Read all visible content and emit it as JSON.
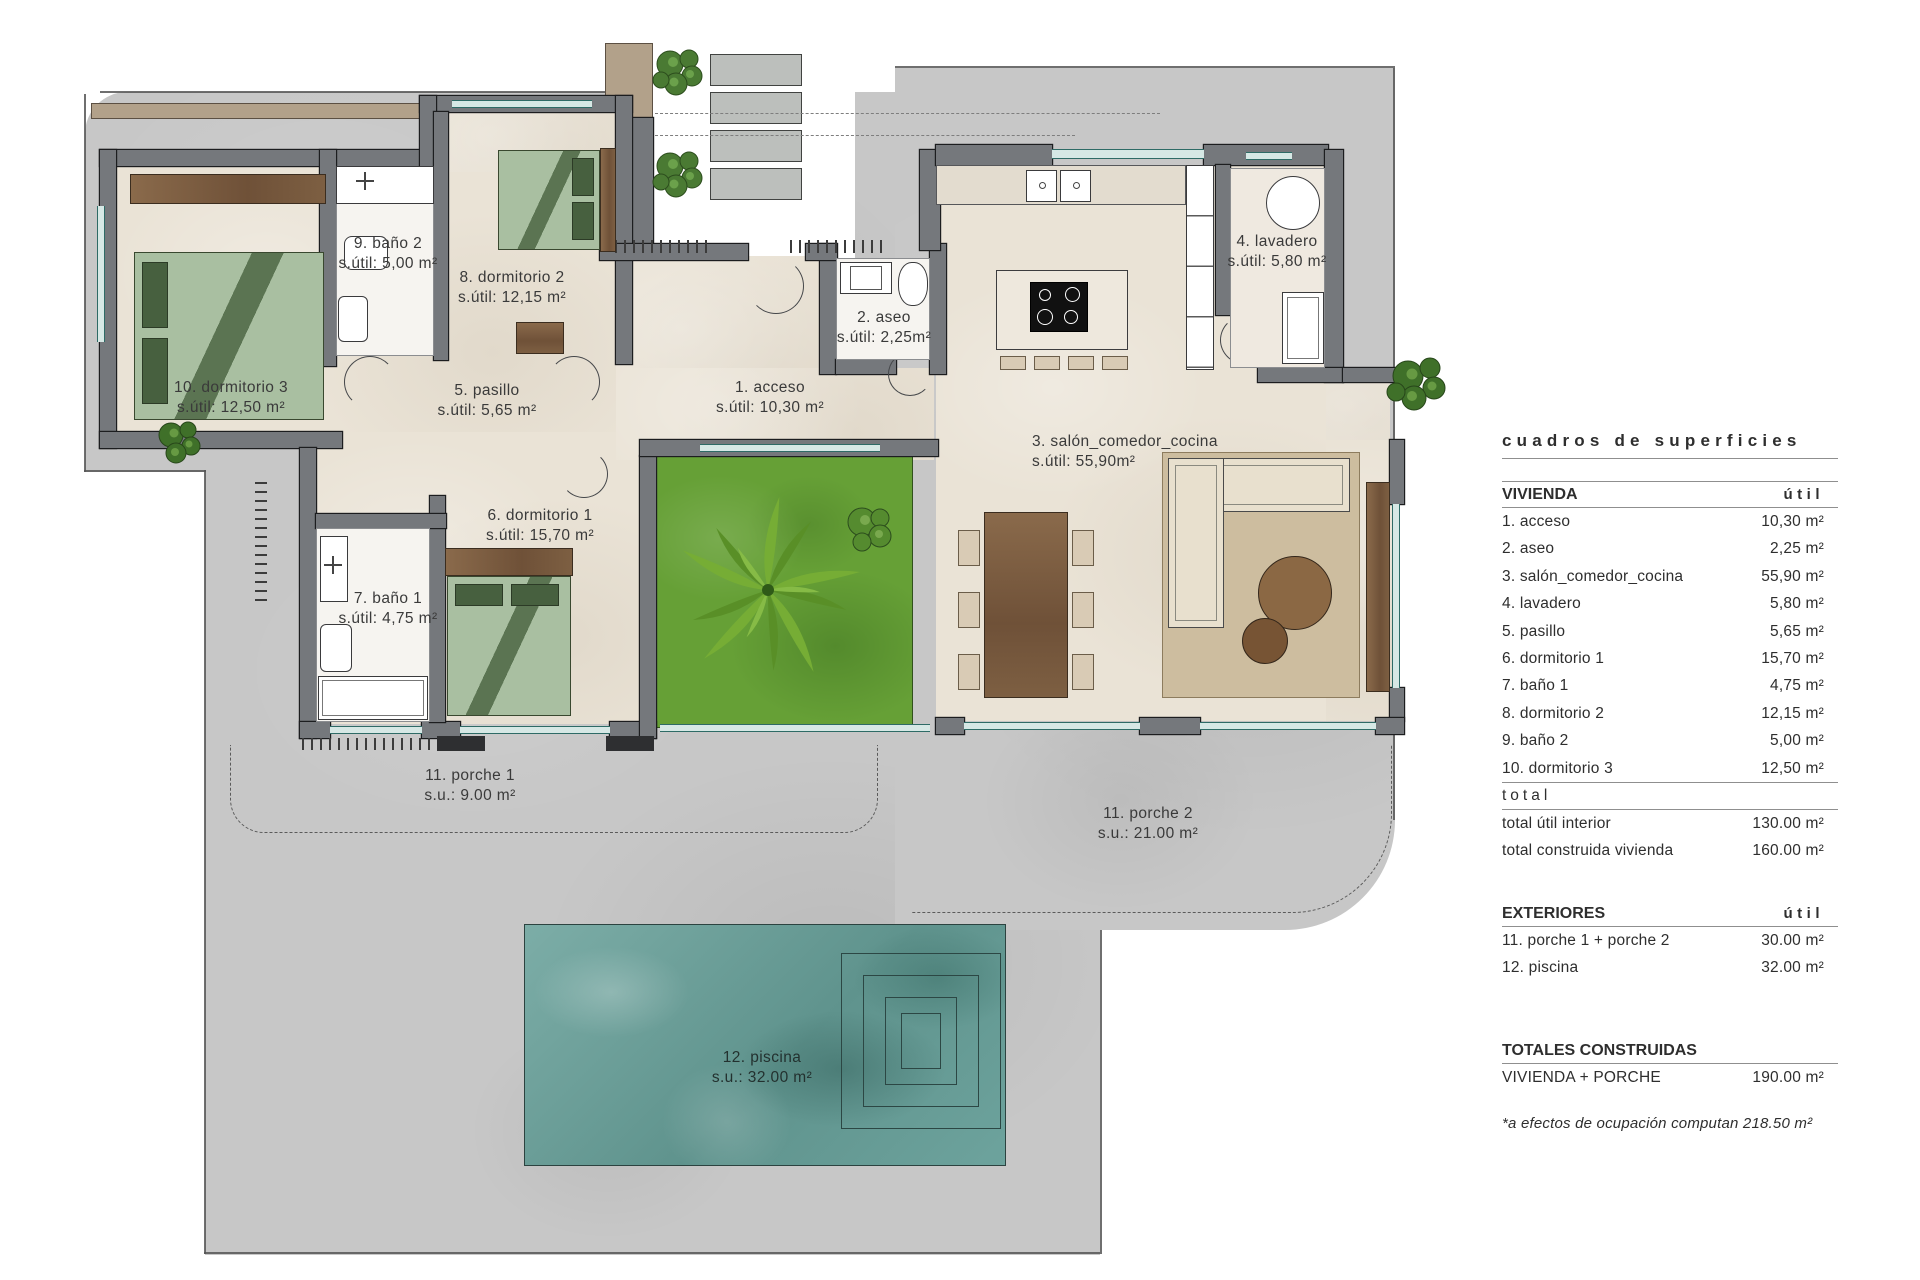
{
  "document": {
    "type": "architectural floor plan"
  },
  "colors": {
    "wall": "#75787c",
    "floor": "#eae3d6",
    "plot": "#c7c7c7",
    "garden": "#66a036",
    "pool": "#6da39d",
    "wood": "#7a5a3c",
    "bed": "#a9bfa1",
    "window": "#2e6b66"
  },
  "plan": {
    "rooms": [
      {
        "id": "1",
        "name": "1. acceso",
        "area_label": "s.útil: 10,30 m²"
      },
      {
        "id": "2",
        "name": "2. aseo",
        "area_label": "s.útil: 2,25m²"
      },
      {
        "id": "3",
        "name": "3. salón_comedor_cocina",
        "area_label": "s.útil: 55,90m²"
      },
      {
        "id": "4",
        "name": "4. lavadero",
        "area_label": "s.útil: 5,80 m²"
      },
      {
        "id": "5",
        "name": "5. pasillo",
        "area_label": "s.útil: 5,65 m²"
      },
      {
        "id": "6",
        "name": "6. dormitorio 1",
        "area_label": "s.útil: 15,70 m²"
      },
      {
        "id": "7",
        "name": "7. baño 1",
        "area_label": "s.útil: 4,75 m²"
      },
      {
        "id": "8",
        "name": "8. dormitorio 2",
        "area_label": "s.útil: 12,15 m²"
      },
      {
        "id": "9",
        "name": "9. baño 2",
        "area_label": "s.útil: 5,00 m²"
      },
      {
        "id": "10",
        "name": "10. dormitorio 3",
        "area_label": "s.útil: 12,50 m²"
      }
    ],
    "exteriors": [
      {
        "id": "11a",
        "name": "11. porche 1",
        "area_label": "s.u.: 9.00 m²"
      },
      {
        "id": "11b",
        "name": "11. porche 2",
        "area_label": "s.u.: 21.00 m²"
      },
      {
        "id": "12",
        "name": "12. piscina",
        "area_label": "s.u.: 32.00 m²"
      }
    ]
  },
  "panel": {
    "title": "cuadros de superficies",
    "vivienda": {
      "heading": "VIVIENDA",
      "col": "útil",
      "rows": [
        {
          "label": "1. acceso",
          "value": "10,30 m²"
        },
        {
          "label": "2. aseo",
          "value": "2,25 m²"
        },
        {
          "label": "3. salón_comedor_cocina",
          "value": "55,90 m²"
        },
        {
          "label": "4. lavadero",
          "value": "5,80 m²"
        },
        {
          "label": "5. pasillo",
          "value": "5,65 m²"
        },
        {
          "label": "6. dormitorio 1",
          "value": "15,70 m²"
        },
        {
          "label": "7. baño 1",
          "value": "4,75 m²"
        },
        {
          "label": "8. dormitorio 2",
          "value": "12,15 m²"
        },
        {
          "label": "9. baño 2",
          "value": "5,00 m²"
        },
        {
          "label": "10. dormitorio 3",
          "value": "12,50 m²"
        }
      ],
      "total_heading": "total",
      "totals": [
        {
          "label": "total útil interior",
          "value": "130.00 m²"
        },
        {
          "label": "total construida vivienda",
          "value": "160.00 m²"
        }
      ]
    },
    "exteriores": {
      "heading": "EXTERIORES",
      "col": "útil",
      "rows": [
        {
          "label": "11. porche 1 + porche 2",
          "value": "30.00 m²"
        },
        {
          "label": "12. piscina",
          "value": "32.00 m²"
        }
      ]
    },
    "totales": {
      "heading": "TOTALES CONSTRUIDAS",
      "rows": [
        {
          "label": "VIVIENDA + PORCHE",
          "value": "190.00 m²"
        }
      ]
    },
    "note": "*a efectos de ocupación computan 218.50 m²"
  }
}
